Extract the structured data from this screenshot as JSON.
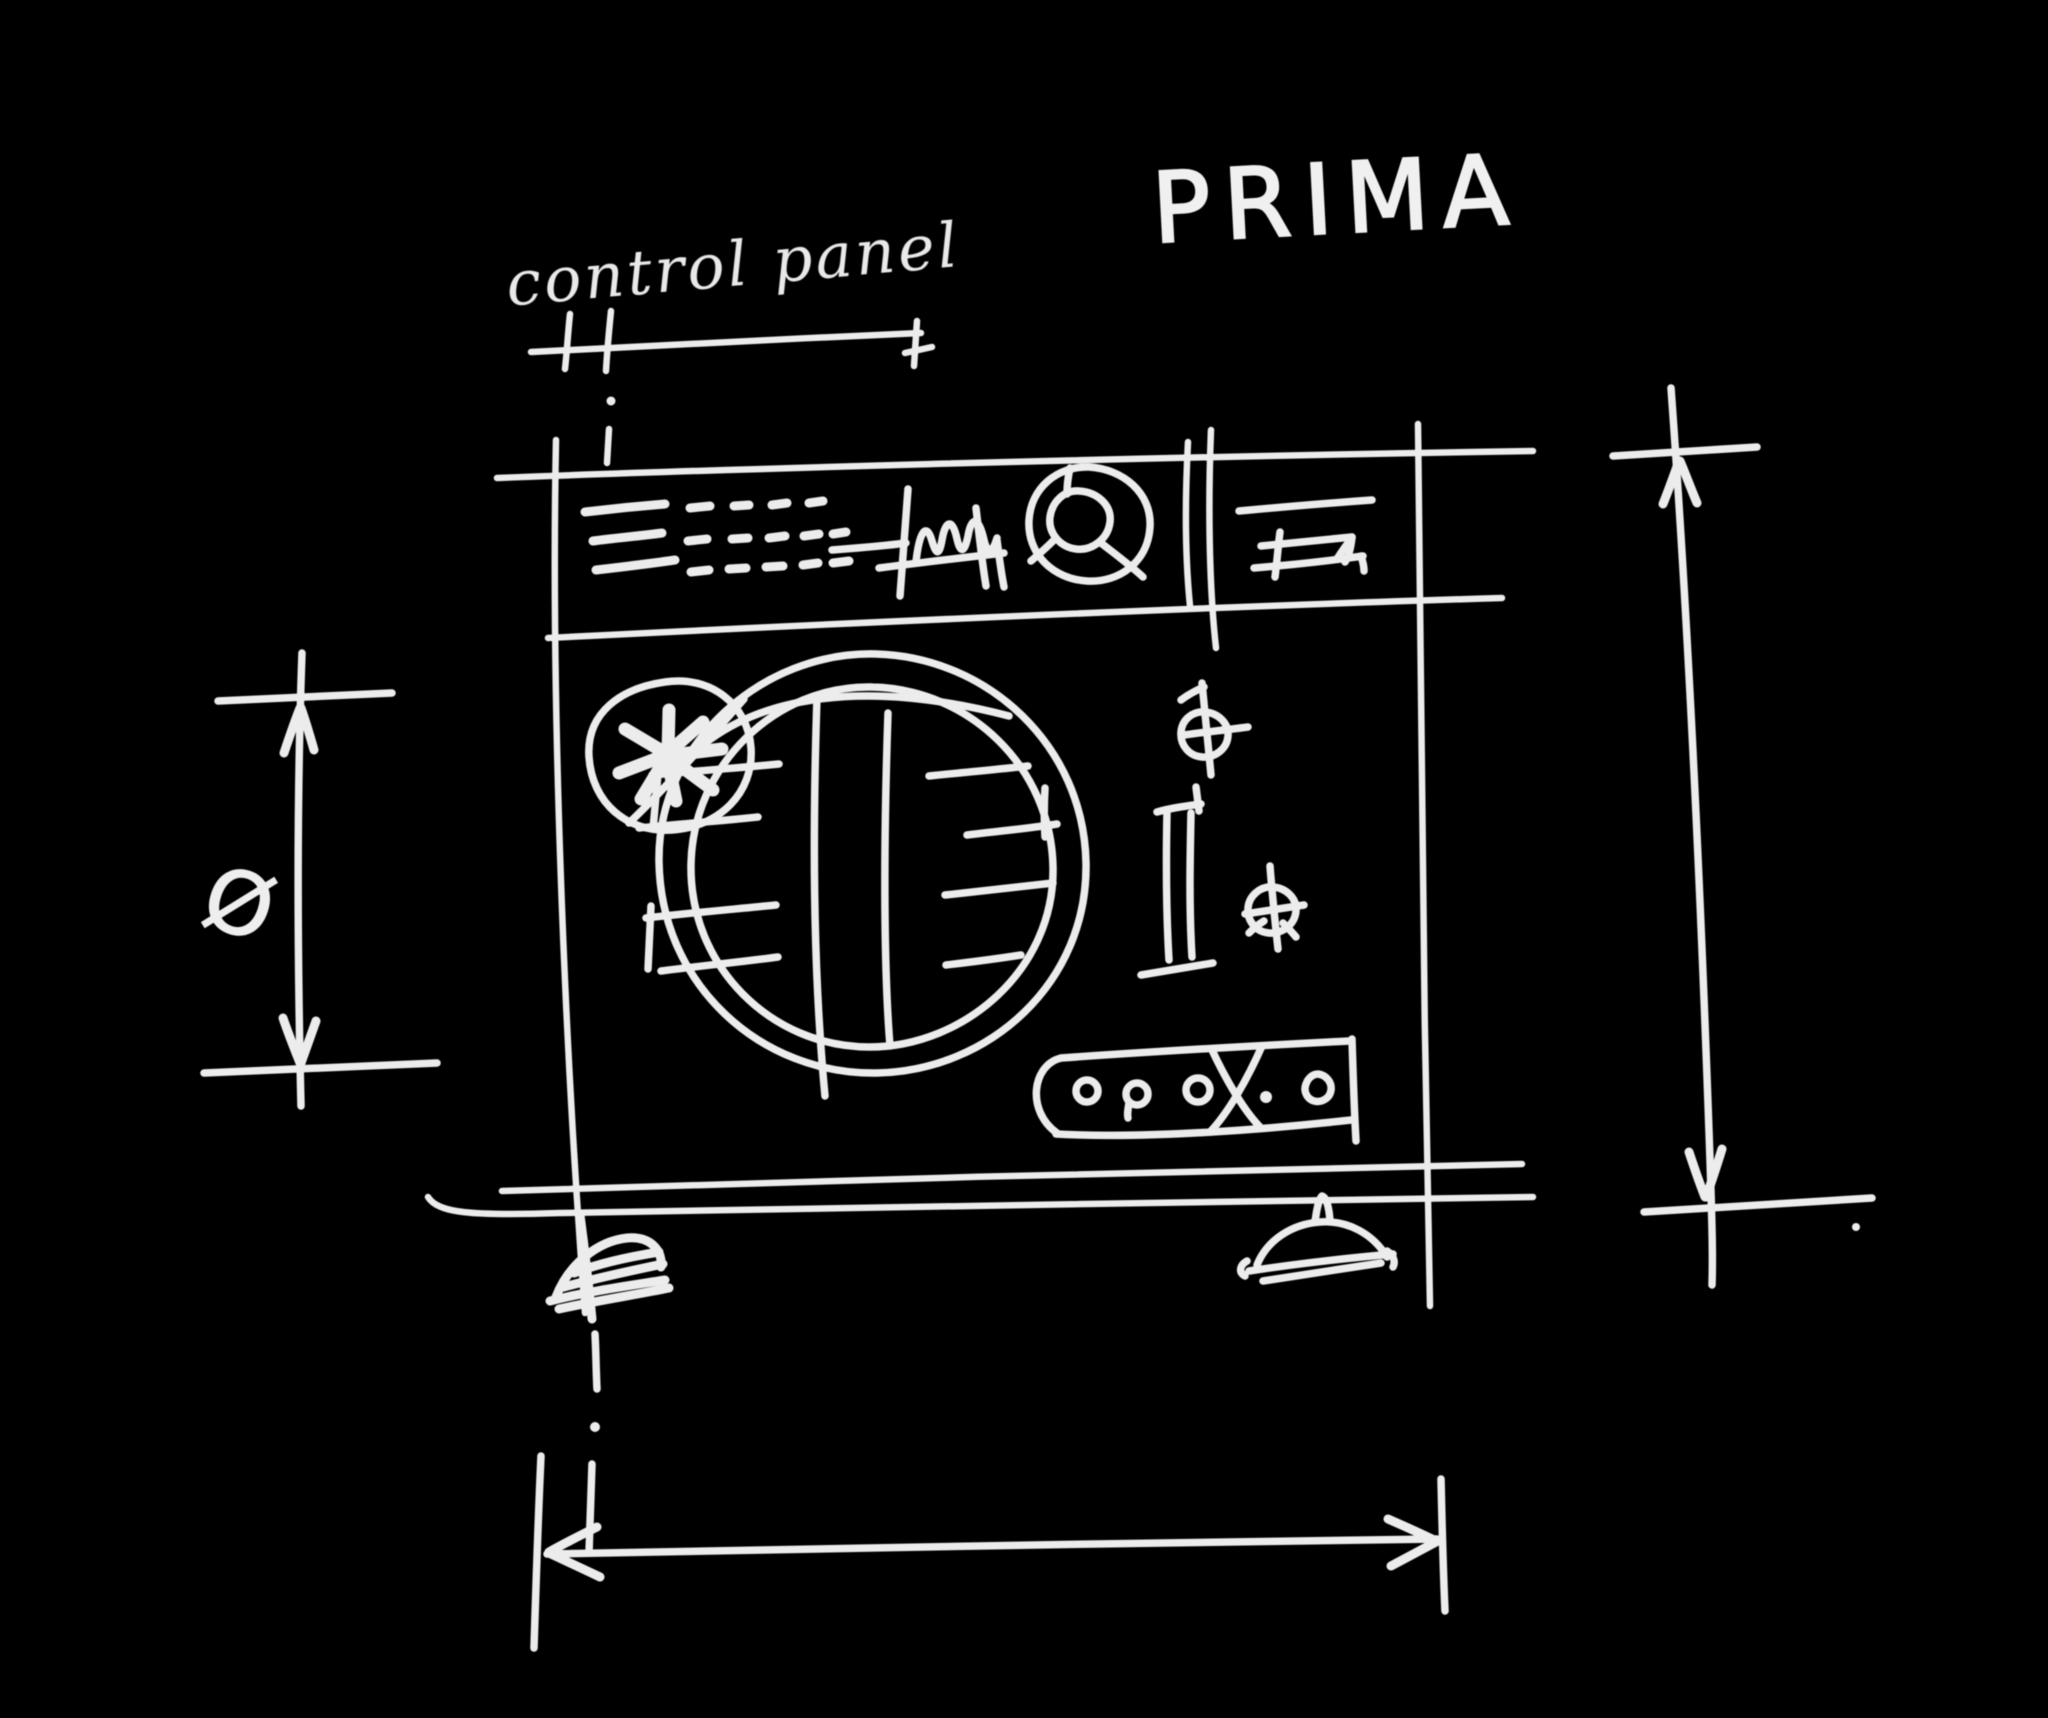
{
  "title": "PRIMA",
  "annotations": {
    "control_panel_label": "control panel",
    "diameter_symbol": "Ø"
  },
  "colors": {
    "background": "#000000",
    "ink": "#ececec"
  },
  "components": {
    "machine_outline": "washing-machine front sketch",
    "control_panel_strip": "top strip with lines, dashes, scribble, dial, drawer",
    "program_dial": "circled knob with spokes",
    "detergent_drawer": "thin slotted box",
    "dispenser_star": "circle with asterisk burst",
    "door_drum": "large double circle with vertical bars and slats",
    "door_hinge": "I-beam shape right of door",
    "screws": "two crosshair screw marks",
    "button_row": "pill with small circles, x and dot",
    "feet": "left scribble foot and right bell foot",
    "dimension_top": "control panel width callout",
    "dimension_left": "drum height with diameter symbol",
    "dimension_right": "overall height arrows",
    "dimension_bottom": "overall width arrows"
  }
}
